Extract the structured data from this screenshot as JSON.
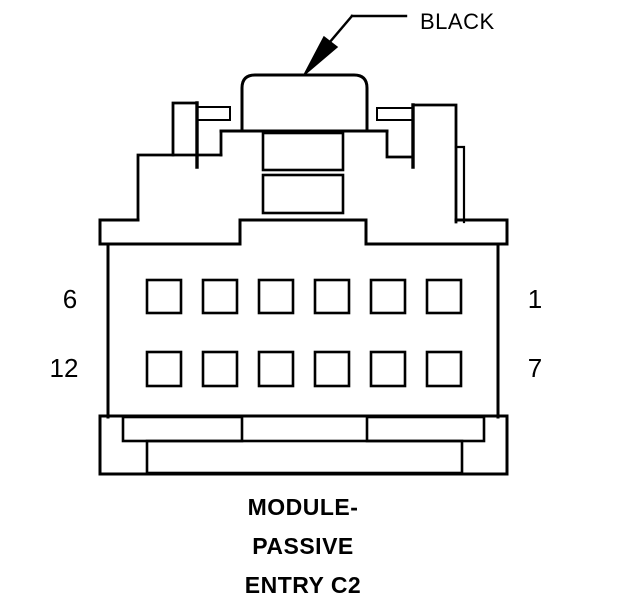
{
  "diagram": {
    "background_color": "#ffffff",
    "line_color": "#000000",
    "wire_label": "BLACK",
    "caption_lines": [
      "MODULE-",
      "PASSIVE",
      "ENTRY C2"
    ],
    "pin_labels": {
      "top_left": "6",
      "top_right": "1",
      "bottom_left": "12",
      "bottom_right": "7"
    },
    "pins": {
      "rows": 2,
      "cols": 6
    }
  }
}
